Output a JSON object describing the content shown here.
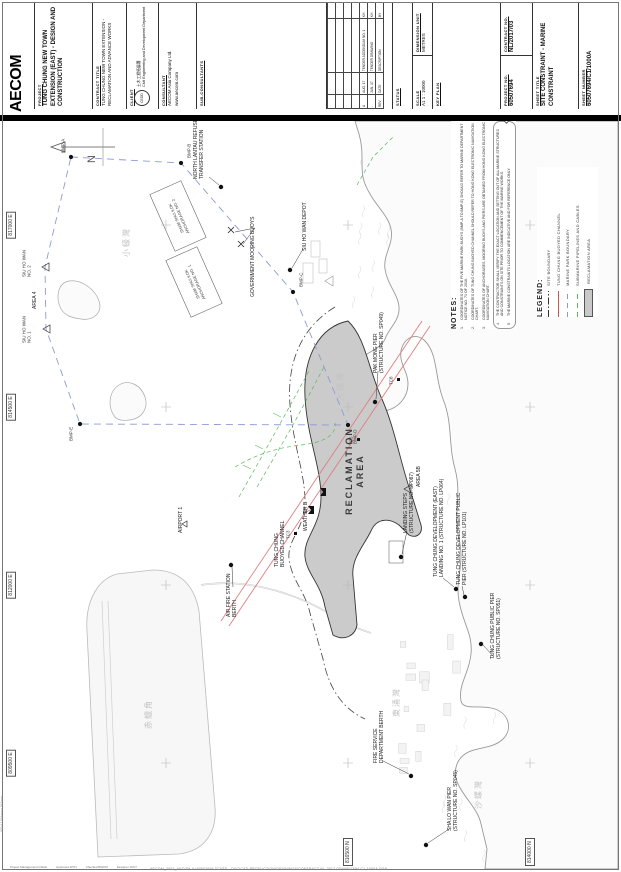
{
  "title_block": {
    "logo": "AECOM",
    "project": {
      "label": "PROJECT",
      "value": "TUNG CHUNG NEW TOWN EXTENSION (EAST) - DESIGN AND CONSTRUCTION"
    },
    "contract_title": {
      "label": "CONTRACT TITLE",
      "value": "TUNG CHUNG NEW TOWN EXTENSION - RECLAMATION AND ADVANCE WORKS"
    },
    "client": {
      "label": "CLIENT",
      "org_cn": "土木工程拓展署",
      "org": "Civil Engineering and Development Department",
      "logo": "CEDD"
    },
    "consultant": {
      "label": "CONSULTANT",
      "value": "AECOM Asia Company Ltd.",
      "url": "www.aecom.com"
    },
    "sub_consultants": {
      "label": "SUB-CONSULTANTS"
    },
    "revisions": {
      "headers": [
        "REV",
        "DATE",
        "DESCRIPTION",
        "BY"
      ],
      "rows": [
        [
          "A",
          "AUG. 17",
          "TENDER ADDENDUM NO. 1",
          "KH"
        ],
        [
          "-",
          "JUN. 17",
          "TENDER DRAWING",
          "KH"
        ]
      ]
    },
    "status": {
      "label": "STATUS",
      "value": ""
    },
    "scale": {
      "label": "SCALE",
      "value": "A1  1 : 10000"
    },
    "dimension_unit": {
      "label": "DIMENSION UNIT",
      "value": "METRES"
    },
    "key_plan": {
      "label": "KEY PLAN"
    },
    "project_no": {
      "label": "PROJECT NO.",
      "value": "60507694"
    },
    "contract_no": {
      "label": "CONTRACT NO.",
      "value": "NL/2017/03"
    },
    "sheet_title": {
      "label": "SHEET TITLE",
      "value": "SITE CONSTRAINT - MARINE CONSTRAINT"
    },
    "sheet_number": {
      "label": "SHEET NUMBER",
      "value": "60507694/C1/1000A"
    }
  },
  "notes": {
    "heading": "NOTES:",
    "revision_marker": "A",
    "items": [
      "COORDINATES OF THE FIVE MARINE PARK BUOYS (BMP-A TO BMP-E) SHOULD REFER TO MARINE DEPARTMENT NOTICE NO. 71 OF 2016.",
      "COORDINATES OF TUNG CHUNG BUOYED CHANNEL SHOULD REFER TO HONG KONG ELECTRONIC NAVIGATION CHART.",
      "COORDINATES OF ANCHORAGES, MOORING BUOYS AND PIERS ARE OBTAINED FROM HONG KONG ELECTRONIC NAVIGATION CHART.",
      "THE CONTRACTOR SHALL VERIFY THE EXACT LOCATION AND SETTING OUT OF ALL MARINE STRUCTURES AND CONSTRAINTS ON SITE PRIOR TO COMMENCEMENT OF THE MARINE WORKS.",
      "THE MARINE CONSTRAINTS LOCATION ARE INDICATIVE AND FOR REFERENCE ONLY."
    ]
  },
  "legend": {
    "heading": "LEGEND:",
    "items": [
      {
        "label": "SITE BOUNDARY",
        "style": "dashdot"
      },
      {
        "label": "TUNG CHUNG BUOYED CHANNEL",
        "style": "red"
      },
      {
        "label": "MARINE PARK BOUNDARY",
        "style": "blue"
      },
      {
        "label": "SUBMARINE PIPELINES AND CABLES",
        "style": "green"
      },
      {
        "label": "RECLAMATION AREA",
        "style": "grey"
      }
    ]
  },
  "map": {
    "north_label": "N",
    "grid": {
      "eastings": [
        {
          "t": "817000 E",
          "x": 644
        },
        {
          "t": "814500 E",
          "x": 462
        },
        {
          "t": "812000 E",
          "x": 284
        },
        {
          "t": "809500 E",
          "x": 106
        }
      ],
      "northings": [
        {
          "t": "816500 N",
          "y": 345
        },
        {
          "t": "814000 N",
          "y": 527
        }
      ],
      "cross_x": [
        106,
        284,
        462,
        644
      ],
      "cross_y": [
        163,
        345,
        527
      ]
    },
    "labels": [
      {
        "n": "label-refuse-transfer-station",
        "t": "NORTH LANTAU REFUSE\nTRANSFER STATION",
        "x": 690,
        "y": 196,
        "c": "ml"
      },
      {
        "n": "label-government-mooring-buoys",
        "t": "GOVERNMENT MOORING BUOYS",
        "x": 572,
        "y": 250,
        "c": "ml"
      },
      {
        "n": "label-siu-ho-wan-depot",
        "t": "SIU HO WAN DEPOT",
        "x": 618,
        "y": 302,
        "c": "ml"
      },
      {
        "n": "label-buoy-bmp-a",
        "t": "BMP-A",
        "x": 716,
        "y": 60,
        "c": "ml bmp"
      },
      {
        "n": "label-buoy-bmp-b",
        "t": "BMP-B",
        "x": 711,
        "y": 186,
        "c": "ml bmp"
      },
      {
        "n": "label-buoy-bmp-c",
        "t": "BMP-C",
        "x": 582,
        "y": 298,
        "c": "ml bmp"
      },
      {
        "n": "label-buoy-bmp-d",
        "t": "BMP-D",
        "x": 425,
        "y": 352,
        "c": "ml bmp"
      },
      {
        "n": "label-buoy-bmp-e",
        "t": "BMP-E",
        "x": 428,
        "y": 68,
        "c": "ml bmp"
      },
      {
        "n": "label-siu-ho-wan-intake-2",
        "t": "SIU HO WAN\nNO. 2",
        "x": 592,
        "y": 24,
        "c": "ml bmp"
      },
      {
        "n": "label-siu-ho-wan-intake-1",
        "t": "SIU HO WAN\nNO. 1",
        "x": 526,
        "y": 24,
        "c": "ml bmp"
      },
      {
        "n": "label-area-4",
        "t": "AREA 4",
        "x": 560,
        "y": 32,
        "c": "ml"
      },
      {
        "n": "label-sham-shui-kok-anchorage-2",
        "t": "SHAM SHUI KOK\nANCHORAGE NO. 2",
        "x": 652,
        "y": 176,
        "c": "ml anch"
      },
      {
        "n": "label-sham-shui-kok-anchorage-1",
        "t": "SHAM SHUI KOK\nANCHORAGE NO. 1",
        "x": 586,
        "y": 192,
        "c": "ml anch"
      },
      {
        "n": "label-pak-mong-pier",
        "t": "PAK MONG PIER\n(STRUCTURE NO. SP049)",
        "x": 496,
        "y": 376,
        "c": "ml"
      },
      {
        "n": "label-reclamation-area",
        "t": "RECLAMATION\nAREA",
        "x": 398,
        "y": 352,
        "c": "ml big ctr"
      },
      {
        "n": "label-area-5b",
        "t": "AREA 5B",
        "x": 382,
        "y": 416,
        "c": "ml"
      },
      {
        "n": "label-landing-steps",
        "t": "LANDING STEPS\n(STRUCTURE NO. SP087)",
        "x": 336,
        "y": 406,
        "c": "ml"
      },
      {
        "n": "label-tce-landing-no-1",
        "t": "TUNG CHUNG DEVELOPMENT (EAST)\nLANDING NO. 1 (STRUCTURE NO. LP064)",
        "x": 292,
        "y": 436,
        "c": "ml"
      },
      {
        "n": "label-tc-development-public-pier",
        "t": "TUNG CHUNG DEVELOPMENT PUBLIC\nPIER (STRUCTURE NO. LP101)",
        "x": 284,
        "y": 459,
        "c": "ml"
      },
      {
        "n": "label-tc-public-pier",
        "t": "TUNG CHUNG PUBLIC PIER\n(STRUCTURE NO. SP051)",
        "x": 210,
        "y": 493,
        "c": "ml"
      },
      {
        "n": "label-fire-service-berth",
        "t": "FIRE SERVICE\nDEPARTMENT BERTH",
        "x": 106,
        "y": 376,
        "c": "ml"
      },
      {
        "n": "label-sha-lo-wan-pier",
        "t": "SHA LO WAN PIER\n(STRUCTURE NO. SP045)",
        "x": 38,
        "y": 450,
        "c": "ml"
      },
      {
        "n": "label-air-fire-station-berth",
        "t": "AIR FIRE STATION\nBERTH",
        "x": 252,
        "y": 229,
        "c": "ml"
      },
      {
        "n": "label-airport-1",
        "t": "AIRPORT 1",
        "x": 336,
        "y": 178,
        "c": "ml"
      },
      {
        "n": "label-weather-b",
        "t": "WEATHER B",
        "x": 338,
        "y": 303,
        "c": "ml"
      },
      {
        "n": "label-tung-chung-buoyed-channel",
        "t": "TUNG CHUNG\nBUOYED CHANNEL",
        "x": 302,
        "y": 277,
        "c": "ml"
      },
      {
        "n": "label-marker-tc3",
        "t": "TC3",
        "x": 330,
        "y": 285,
        "c": "ml bmp"
      },
      {
        "n": "label-marker-tc5",
        "t": "TC5",
        "x": 424,
        "y": 348,
        "c": "ml bmp"
      },
      {
        "n": "label-marker-tc8",
        "t": "TC8",
        "x": 484,
        "y": 388,
        "c": "ml bmp"
      },
      {
        "n": "label-siu-ho-wan-cn",
        "t": "小蠔灣",
        "x": 612,
        "y": 124,
        "c": "ml cn"
      },
      {
        "n": "label-tai-ho-wan-cn",
        "t": "大蠔灣",
        "x": 468,
        "y": 338,
        "c": "ml cn"
      },
      {
        "n": "label-tung-chung-wan-cn",
        "t": "東涌灣",
        "x": 152,
        "y": 394,
        "c": "ml cn"
      },
      {
        "n": "label-chek-lap-kok-cn",
        "t": "赤鱲角",
        "x": 140,
        "y": 146,
        "c": "ml cn"
      },
      {
        "n": "label-sha-lo-wan-cn",
        "t": "沙螺灣",
        "x": 60,
        "y": 476,
        "c": "ml cn"
      }
    ]
  },
  "margin": {
    "stamp": "AECOM_2002_AECOM   X:\\60507694 TCNTE - D&C\\CAD PRODUCTION\\DRAWINGS\\CONTRACT NL-2017-03\\60507694-C1-1000A.DGN",
    "sheet_size_note": "ISO A1 594mm x 841mm",
    "approvals": [
      "Project Management Initials",
      "Approved  WYN",
      "Checked  BWKM",
      "Designer  JKKT"
    ],
    "plot_date": "11.08.17"
  }
}
